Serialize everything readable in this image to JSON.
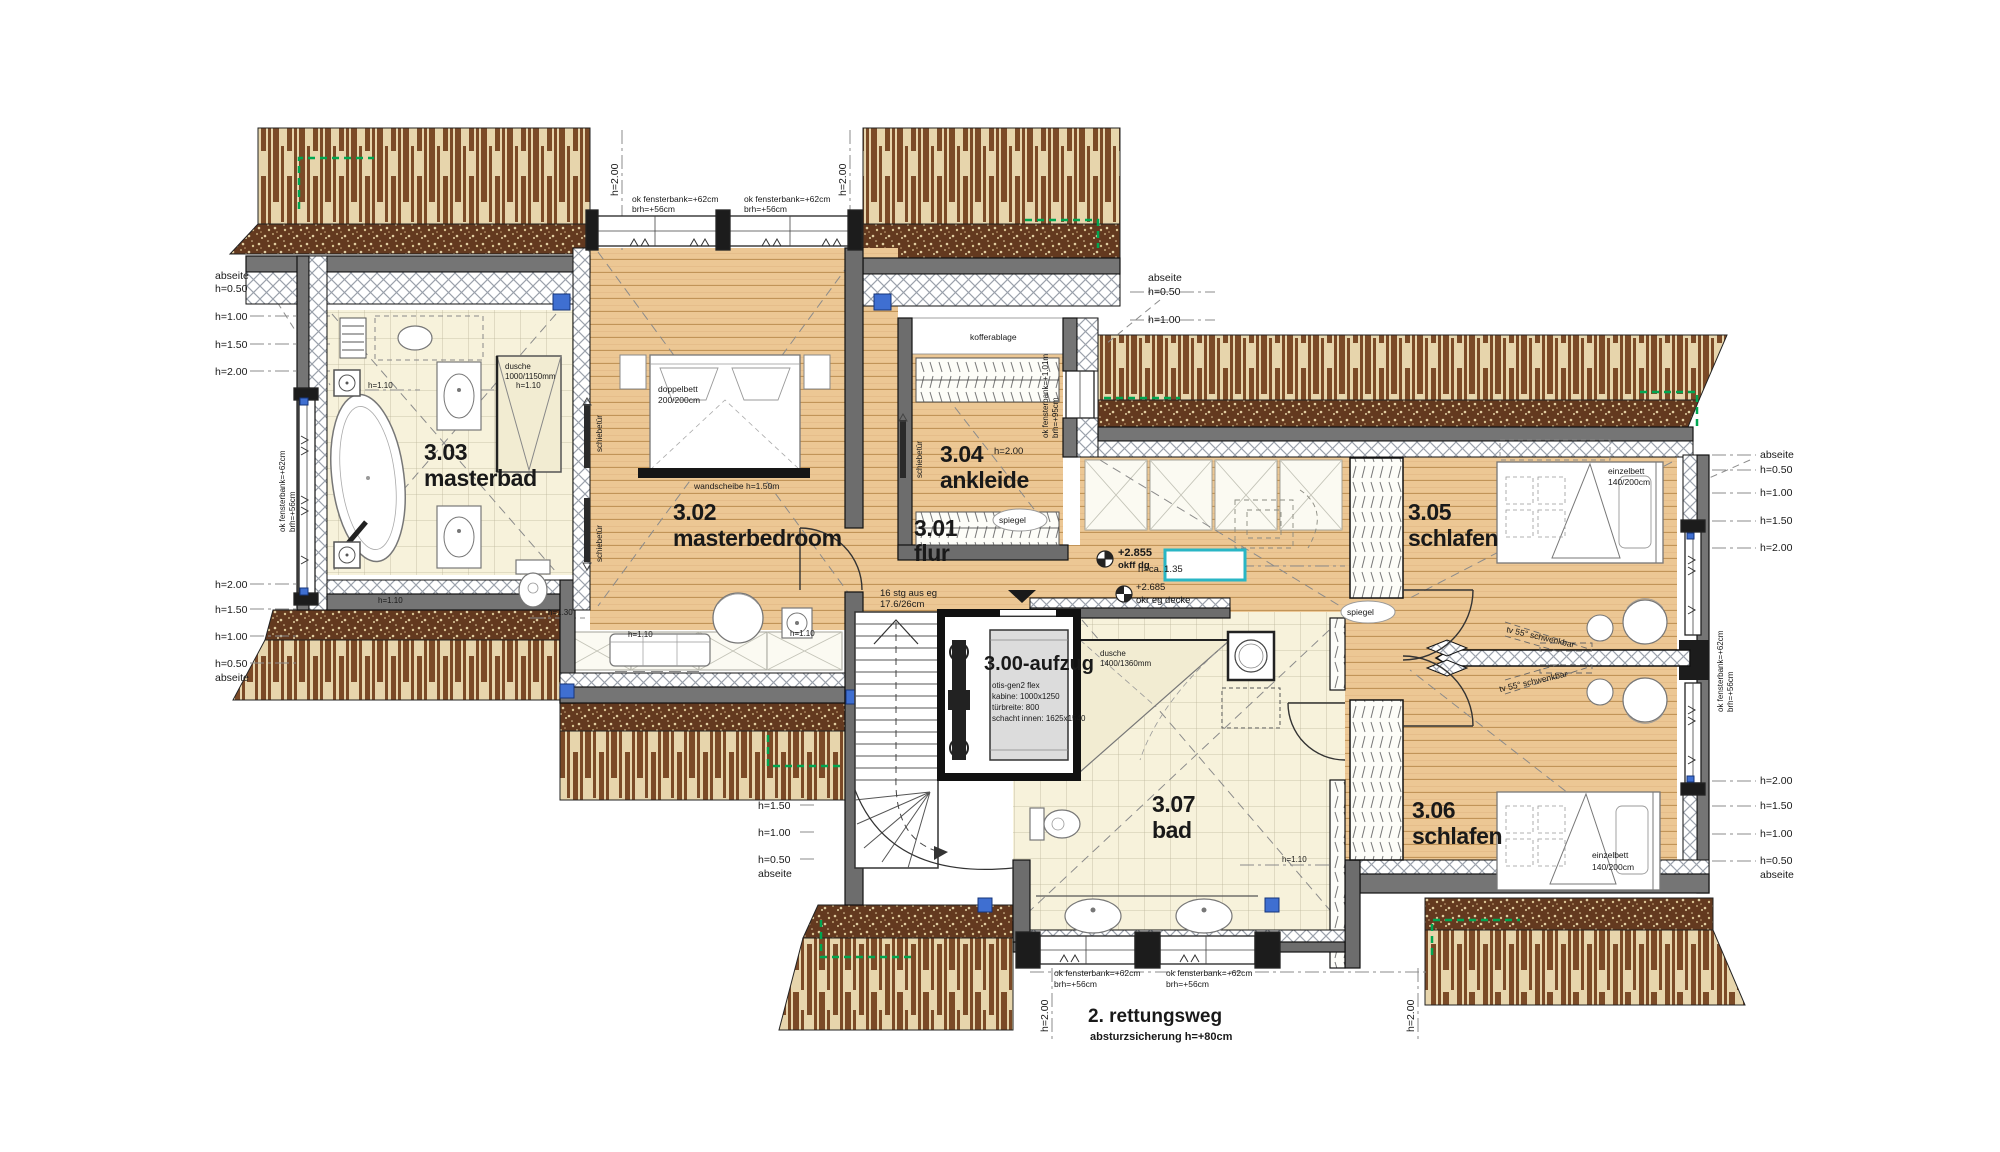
{
  "rooms": {
    "aufzug": {
      "label": "3.00-aufzug",
      "spec1": "otis-gen2 flex",
      "spec2": "kabine: 1000x1250",
      "spec3": "türbreite: 800",
      "spec4": "schacht innen: 1625x1540"
    },
    "flur": {
      "number": "3.01",
      "name": "flur"
    },
    "masterbedroom": {
      "number": "3.02",
      "name": "masterbedroom"
    },
    "masterbad": {
      "number": "3.03",
      "name": "masterbad"
    },
    "ankleide": {
      "number": "3.04",
      "name": "ankleide"
    },
    "schlafen_305": {
      "number": "3.05",
      "name": "schlafen"
    },
    "schlafen_306": {
      "number": "3.06",
      "name": "schlafen"
    },
    "bad": {
      "number": "3.07",
      "name": "bad"
    }
  },
  "escape_route": {
    "line1": "2. rettungsweg",
    "line2": "absturzsicherung  h=+80cm"
  },
  "level_marks": {
    "upper_value": "+2.855",
    "upper_ref": "okff  dg",
    "lower_value": "+2.685",
    "lower_ref": "okr  eg  decke"
  },
  "stair_note": {
    "line1": "16  stg  aus  eg",
    "line2": "17.6/26cm"
  },
  "furniture": {
    "doppelbett_line1": "doppelbett",
    "doppelbett_line2": "200/200cm",
    "einzelbett_line1": "einzelbett",
    "einzelbett_line2": "140/200cm",
    "dusche_master_line1": "dusche",
    "dusche_master_line2": "1000/1150mm",
    "dusche_bad_line1": "dusche",
    "dusche_bad_line2": "1400/1360mm",
    "tv_note": "tv  55°  schwenkbar",
    "spiegel": "spiegel",
    "kofferablage": "kofferablage",
    "wandscheibe_note": "wandscheibe  h=1.50m",
    "schiebetuer": "schiebetür"
  },
  "window_notes": {
    "sill_standard_line1": "ok  fensterbank=+62cm",
    "sill_standard_line2": "brh=+56cm",
    "sill_ankleide_line1": "ok  fensterbank=+1.01m",
    "sill_ankleide_line2": "brh=+95cm"
  },
  "height_marks": {
    "abseite": "abseite",
    "h_050": "h=0.50",
    "h_100": "h=1.00",
    "h_150": "h=1.50",
    "h_200": "h=2.00",
    "h_110": "h=1.10",
    "h_130": "h=1.30",
    "h_ca_135": "h=ca.  1.35"
  },
  "colors": {
    "wood": "#ecc794",
    "tile": "#f7f2db",
    "roof_strip": "#7b4a27",
    "roof_speckle": "#63391f",
    "wall_gray": "#757575",
    "accent_cyan": "#29b6c5",
    "accent_green": "#00a651",
    "accent_blue": "#3f6fd1"
  }
}
